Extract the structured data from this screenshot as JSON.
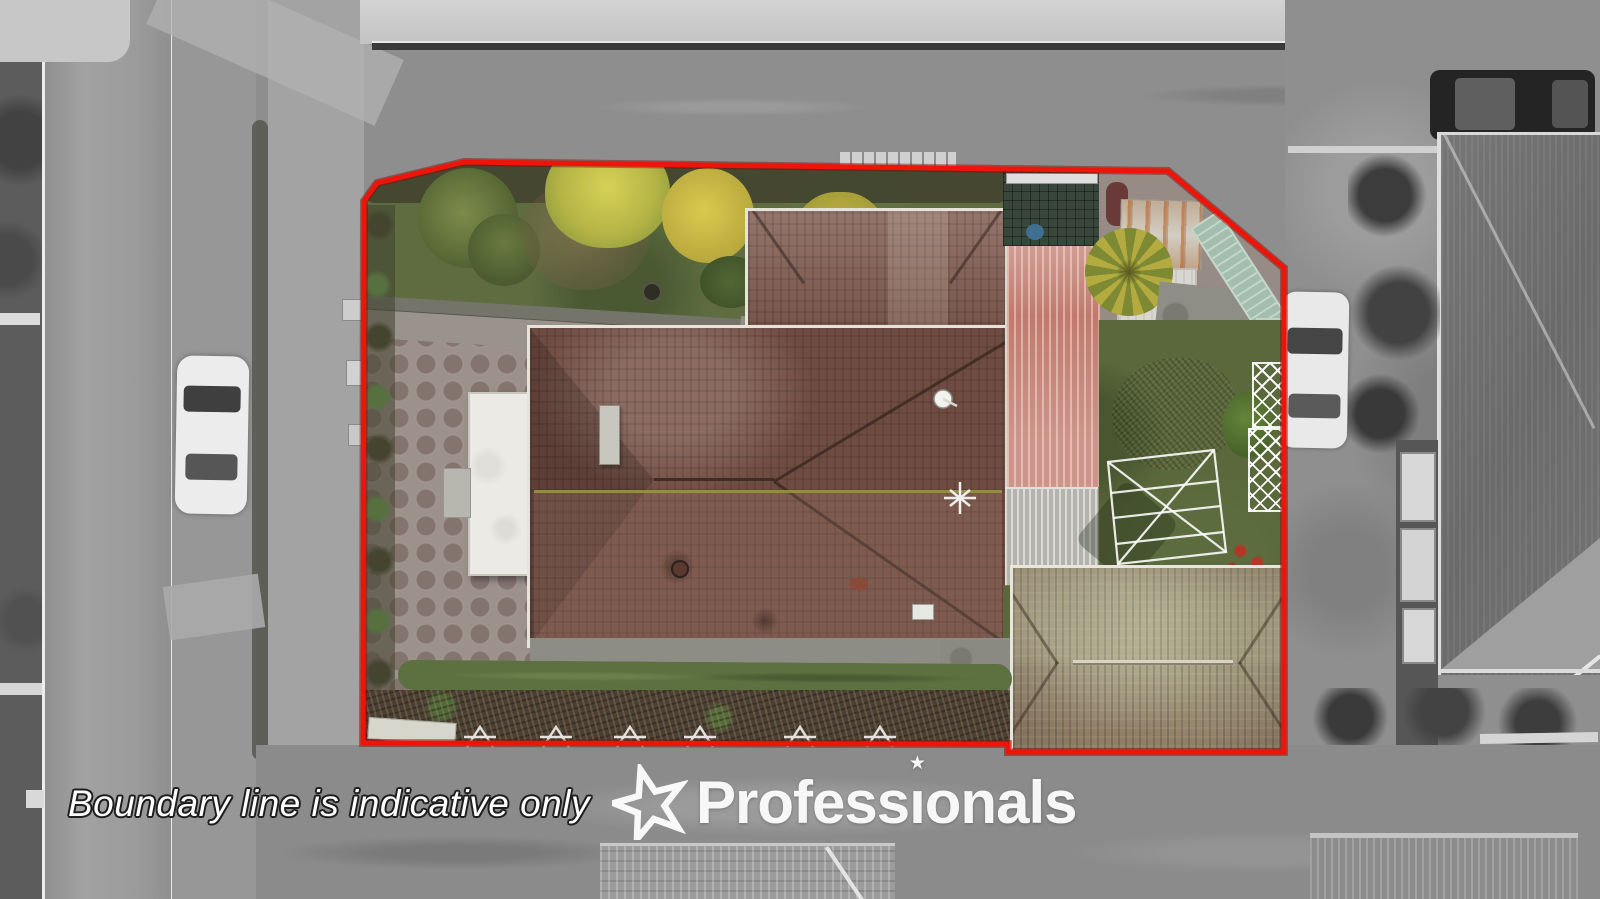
{
  "overlay": {
    "disclaimer": "Boundary line is indicative only",
    "brand": "Professionals",
    "brand_pre": "Profess",
    "brand_i": "ı",
    "brand_post": "onals",
    "brand_star": "★"
  },
  "colors": {
    "boundary_red": "#ee1409",
    "boundary_red_dark": "#7e0b05",
    "logo_white": "#ffffff"
  }
}
